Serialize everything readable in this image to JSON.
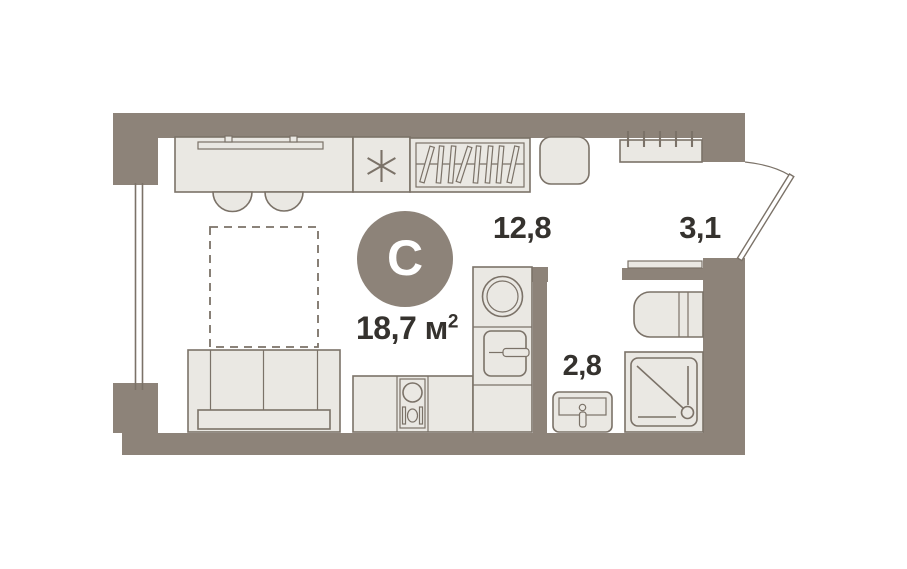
{
  "plan": {
    "badge_letter": "С",
    "total_area": {
      "value": "18,7",
      "unit": "м",
      "sup": "2"
    },
    "rooms": [
      {
        "key": "living_kitchen",
        "area": "12,8"
      },
      {
        "key": "hallway",
        "area": "3,1"
      },
      {
        "key": "bathroom",
        "area": "2,8"
      }
    ]
  },
  "colors": {
    "wall": "#8d8379",
    "line": "#7b7268",
    "fill": "#eae8e3",
    "bg": "#ffffff",
    "text": "#35322e",
    "badge_bg": "#8d8379",
    "badge_text": "#ffffff"
  }
}
